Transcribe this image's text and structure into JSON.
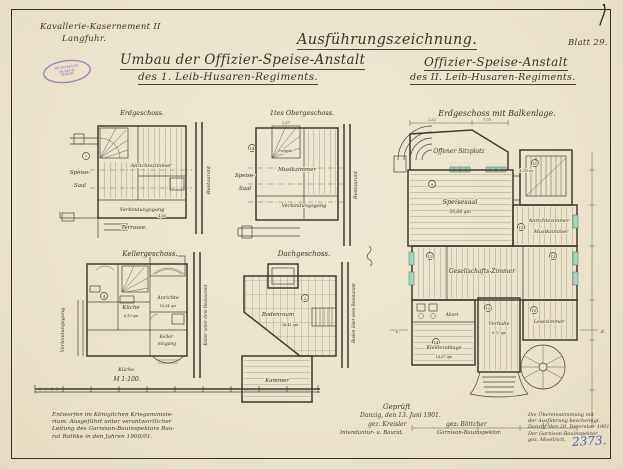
{
  "sheet": {
    "corner_label": "Blatt 29.",
    "registry_number": "2373.",
    "scale_label": "M 1:100."
  },
  "header": {
    "location": {
      "line1": "Kavallerie-Kasernement II",
      "line2": "Langfuhr."
    },
    "left_title": {
      "line1": "Umbau der Offizier-Speise-Anstalt",
      "line2": "des 1. Leib-Husaren-Regiments."
    },
    "right_title": "Ausführungszeichnung.",
    "right_subtitle": {
      "line1": "Offizier-Speise-Anstalt",
      "line2": "des II. Leib-Husaren-Regiments."
    }
  },
  "stamp": {
    "line1": "ARCHITEKTUR-",
    "line2": "MUSEUM",
    "line3": "BERLIN"
  },
  "plans": {
    "erdgeschoss": {
      "title": "Erdgeschoss.",
      "speise_line1": "Speise-",
      "speise_line2": "Saal",
      "anrichte": "Anrichtezimmer",
      "gang": "Verbindungsgang",
      "terrasse": "Terrasse.",
      "context": "Restaurant",
      "dim": "4,50",
      "num": "7"
    },
    "obergeschoss": {
      "title": "1tes Obergeschoss.",
      "treppe": "Treppe",
      "speise_line1": "Speise-",
      "speise_line2": "Saal",
      "musik": "Musikzimmer",
      "gang": "Verbindungsgang",
      "context": "Restaurant",
      "dim": "2,37",
      "num": "14"
    },
    "kellergeschoss": {
      "title": "Kellergeschoss.",
      "kueche": "Küche",
      "kueche_area": "6,10 qm",
      "anrichte": "Anrichte",
      "anrichte_area": "16,54 qm",
      "keller_line1": "Keller-",
      "keller_line2": "eingang",
      "vgang": "Verbindungsgang",
      "annex": "Küche.",
      "context": "Keller unter dem Restaurant",
      "num": "4"
    },
    "dachgeschoss": {
      "title": "Dachgeschoss.",
      "boden": "Bodenraum",
      "boden_area": "34,41 qm",
      "kammer": "Kammer",
      "context": "Boden über dem Restaurant",
      "num": "2"
    },
    "hauptplan": {
      "title": "Erdgeschoss mit Balkenlage.",
      "rooms": {
        "sitzplatz": "Offener Sitzplatz",
        "speisesaal": "Speisesaal",
        "speisesaal_area": "59,68 qm",
        "anrichte": "Anrichtezimmer",
        "musik": "Musikzimmer",
        "gesellschaft": "Gesellschafts-Zimmer",
        "vorhalle": "Vorhalle",
        "vorhalle_area": "9,72 qm",
        "lese": "Lesezimmer",
        "kleider": "Kleiderablage",
        "kleider_area": "14,97 qm",
        "abort": "Abort"
      },
      "dims": {
        "porch_left": "2,52",
        "porch_right": "7,75",
        "treppe": "4,70 m",
        "bottom_left": "7,27",
        "bottom_right": "4,51"
      },
      "marks": {
        "c": "c.",
        "d": "d."
      },
      "nums": [
        "9",
        "10",
        "11",
        "12",
        "13",
        "14",
        "15",
        "16"
      ]
    }
  },
  "notes": {
    "execution": {
      "line1": "Entworfen im Königlichen Kriegsministe-",
      "line2": "rium. Ausgeführt unter verantwortlicher",
      "line3": "Leitung des Garnison-Bauinspektors Bau-",
      "line4": "rat Rothke in den Jahren 1900/01."
    },
    "approval": {
      "gep": "Geprüft",
      "date": "Danzig, den 13. Juni 1901.",
      "sig1": "gez. Kreisler",
      "sig2": "gez. Böttcher",
      "role1": "Intendantur- u. Baurat.",
      "role2": "Garnison-Bauinspektor."
    },
    "certify": {
      "line1": "Die Übereinstimmung mit",
      "line2": "der Ausführung bescheinigt.",
      "line3": "Danzig, den 20. Dezember 1901.",
      "line4": "Der Garnison-Bauinspektor.",
      "line5": "gez. Moellrich."
    }
  },
  "colors": {
    "paper": "#ece3cd",
    "ink": "#3b352a",
    "stamp_purple": "#7d5fa8",
    "blue_ink": "#4a5fb5",
    "window_highlight": "#9fd9c6"
  }
}
